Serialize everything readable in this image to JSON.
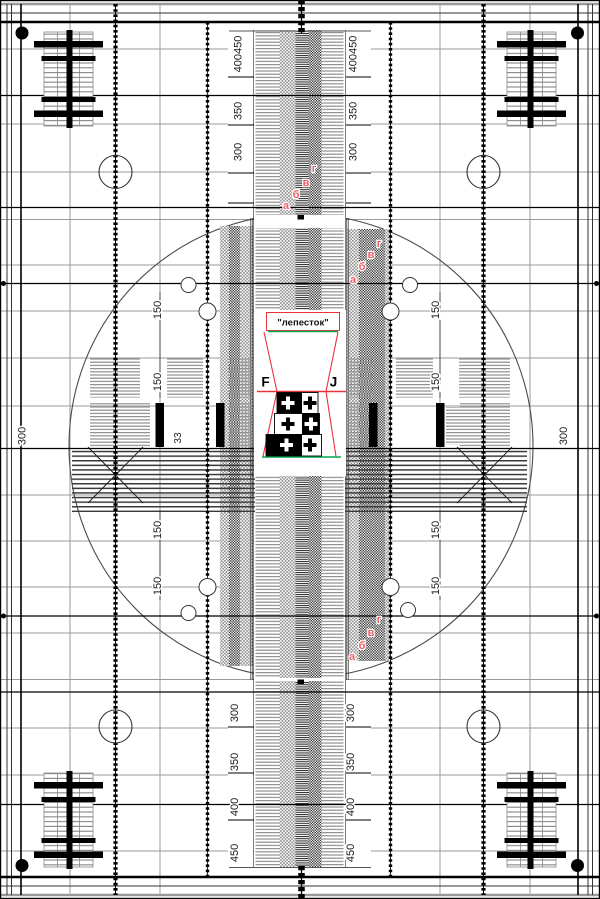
{
  "labels": {
    "petal": "\"лепесток\"",
    "focus_left": "F",
    "focus_right": "J",
    "res_top": [
      "400450",
      "350",
      "300"
    ],
    "res_bottom": [
      "300",
      "350",
      "400",
      "450"
    ],
    "inner_resolution": "150",
    "bar_scale": "33",
    "edge_resolution": "300",
    "strip_letters": [
      "а",
      "б",
      "в",
      "г"
    ]
  },
  "colors": {
    "letter_pink": "#ee5d66",
    "line_red": "#e8323c",
    "line_green": "#00a550",
    "ink_black": "#000000",
    "grid_gray": "#999999"
  }
}
